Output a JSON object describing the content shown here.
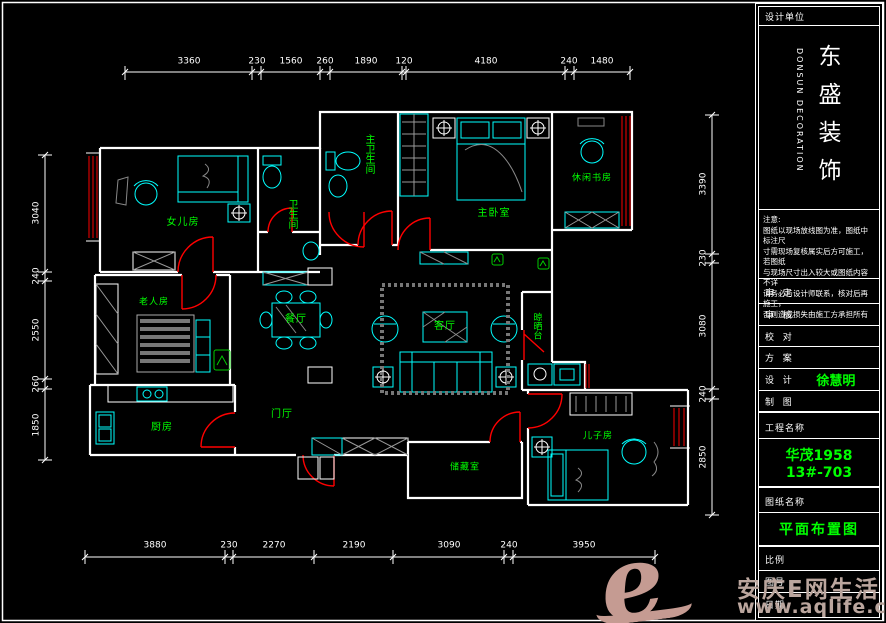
{
  "floor_plan": {
    "rooms": {
      "daughter": "女儿房",
      "guest_bath": "卫生间",
      "master_bath": "主卫生间",
      "master_bed": "主卧室",
      "study": "休闲书房",
      "dining": "餐厅",
      "living": "客厅",
      "foyer": "门厅",
      "elder": "老人房",
      "kitchen": "厨房",
      "storage": "储藏室",
      "son": "儿子房",
      "balcony": "晾晒台"
    },
    "dims": {
      "top": [
        "3360",
        "230",
        "1560",
        "260",
        "1890",
        "120",
        "4180",
        "240",
        "1480"
      ],
      "bottom": [
        "3880",
        "230",
        "2270",
        "2190",
        "3090",
        "240",
        "3950"
      ],
      "left": [
        "3040",
        "240",
        "2550",
        "260",
        "1850"
      ],
      "right": [
        "3390",
        "230",
        "3080",
        "240",
        "2850"
      ]
    }
  },
  "title_block": {
    "design_unit_label": "设计单位",
    "company_cn": "东盛装饰",
    "company_en": "DONSUN DECORATION",
    "note_title": "注意:",
    "note_lines": [
      "图纸以现场放线图为准，图纸中标注尺",
      "寸需现场复核属实后方可施工，若图纸",
      "与现场尺寸出入较大或图纸内容不详",
      "请务必与设计师联系，核对后再施工，",
      "否则造成损失由施工方承担所有"
    ],
    "fields": [
      {
        "label": "审  定",
        "value": ""
      },
      {
        "label": "审  核",
        "value": ""
      },
      {
        "label": "校  对",
        "value": ""
      },
      {
        "label": "方  案",
        "value": ""
      },
      {
        "label": "设  计",
        "value": "徐慧明"
      },
      {
        "label": "制  图",
        "value": ""
      }
    ],
    "project_label": "工程名称",
    "project_value": "华茂1958 13#-703",
    "drawing_label": "图纸名称",
    "drawing_value": "平面布置图",
    "scale_label": "比例",
    "sheet_label": "图号",
    "date_label": "日期"
  },
  "watermark": {
    "logo": "e",
    "site_name": "安庆E网生活",
    "site_url": "www.aqlife.com"
  },
  "colors": {
    "wall": "#ffffff",
    "furniture": "#00ffff",
    "room_label": "#00ff00",
    "door": "#ff0000",
    "hatch": "#888888",
    "watermark": "#bba69e",
    "background": "#000000"
  }
}
